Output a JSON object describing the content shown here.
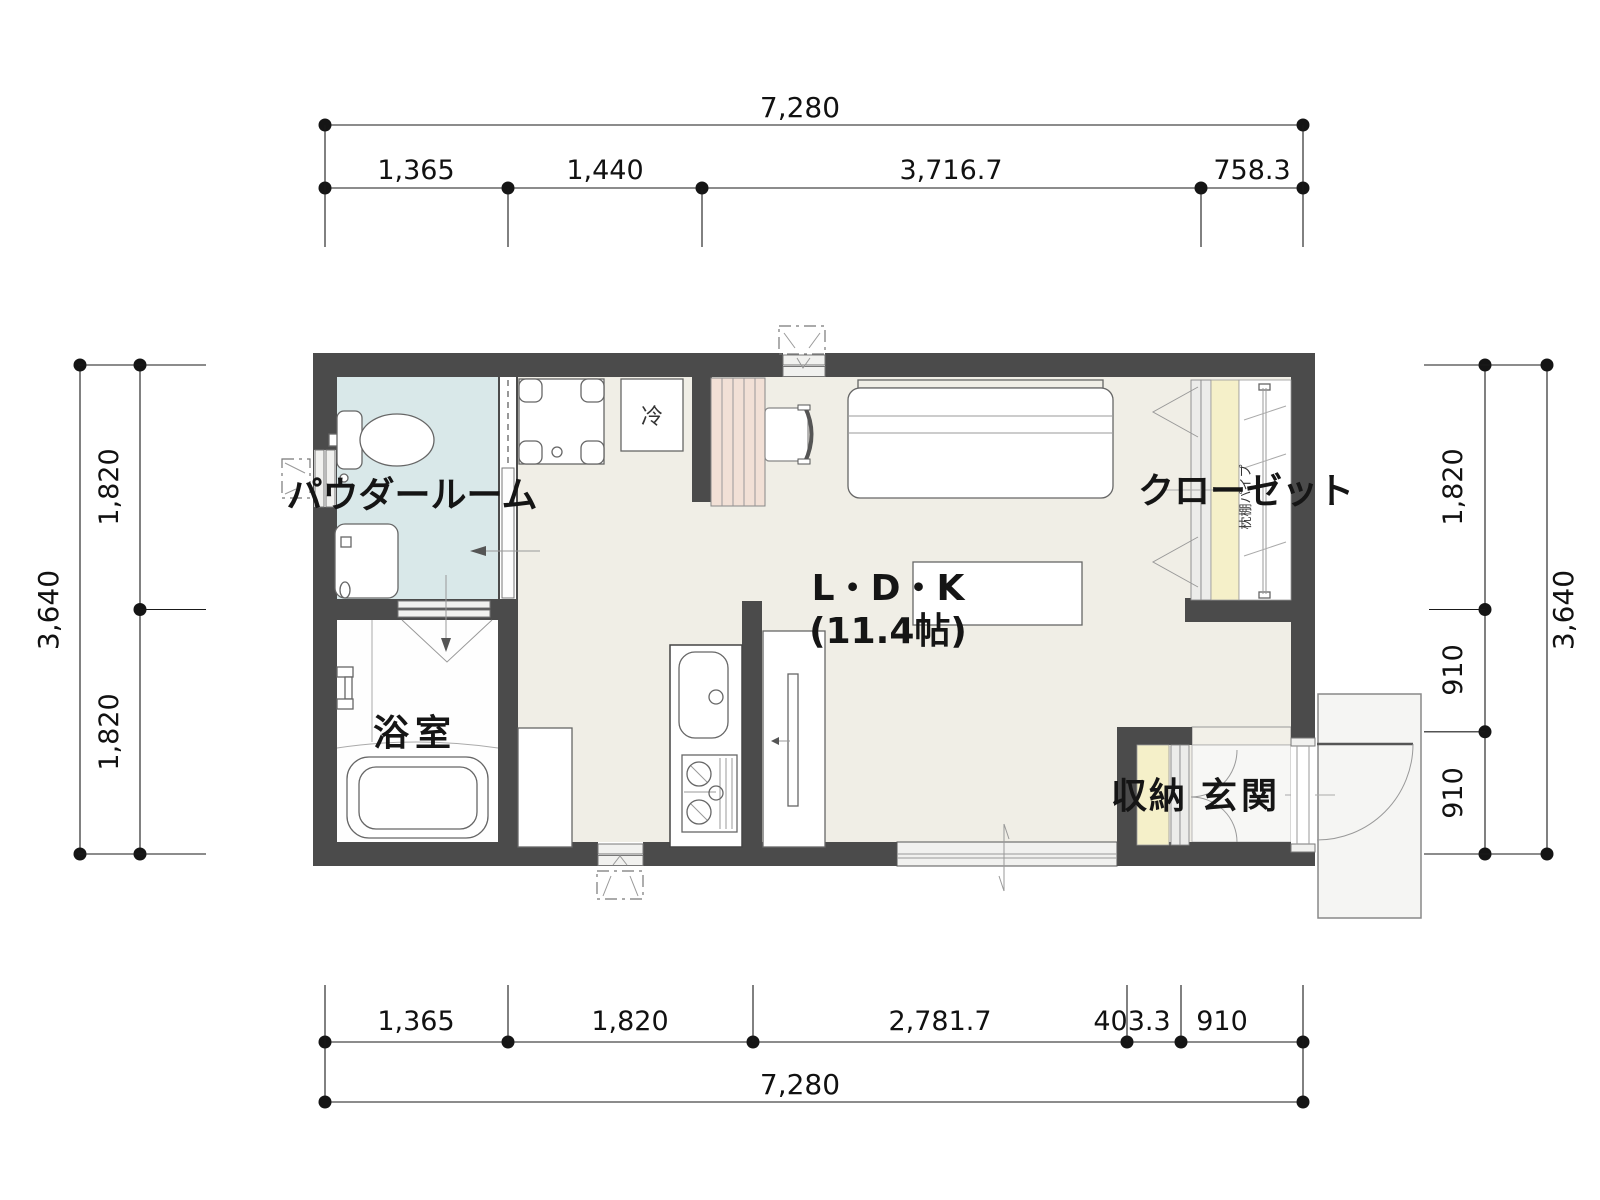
{
  "floor_plan": {
    "rooms": {
      "powder_room": "パウダールーム",
      "bathroom": "浴室",
      "ldk_name": "L・D・K",
      "ldk_size": "(11.4帖)",
      "closet": "クローゼット",
      "closet_shelf_note": "枕棚パイプ",
      "storage": "収納",
      "entrance": "玄関",
      "refrigerator": "冷"
    },
    "dimensions": {
      "top": {
        "total": "7,280",
        "segments": [
          "1,365",
          "1,440",
          "3,716.7",
          "758.3"
        ]
      },
      "bottom": {
        "total": "7,280",
        "segments": [
          "1,365",
          "1,820",
          "2,781.7",
          "403.3",
          "910"
        ]
      },
      "left": {
        "total": "3,640",
        "segments": [
          "1,820",
          "1,820"
        ]
      },
      "right": {
        "total": "3,640",
        "segments": [
          "1,820",
          "910",
          "910"
        ]
      }
    },
    "colors": {
      "wall": "#4b4b4b",
      "ldk_floor": "#f0eee6",
      "powder_room_floor": "#d9e8e9",
      "bathroom_floor": "#fefefe",
      "closet_shelf": "#f5f0c9",
      "desk_counter": "#f2e0d6",
      "entrance_floor": "#f7f7f5",
      "dimension_line": "#1a1a1a"
    }
  }
}
